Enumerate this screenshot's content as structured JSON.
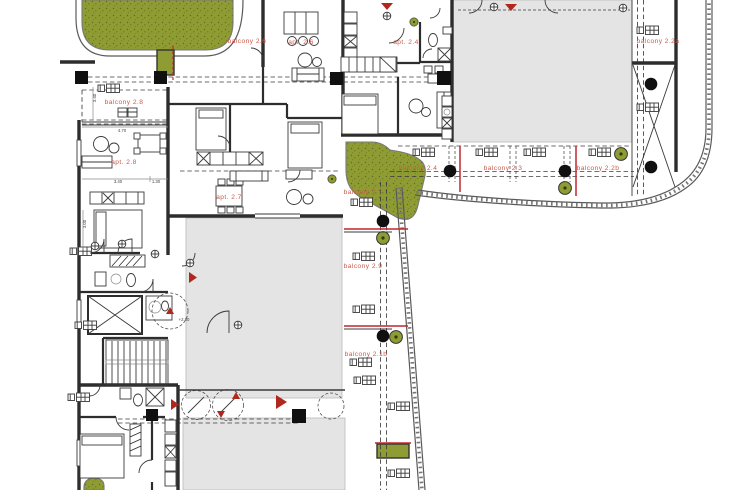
{
  "canvas": {
    "width": 734,
    "height": 490
  },
  "colors": {
    "background": "#ffffff",
    "grass": "#8f9c33",
    "grass_speckle": "#5f6d1c",
    "slab": "#e4e4e4",
    "wall": "#2d2d2d",
    "label_red": "#cd594b",
    "accent_red": "#c1272d",
    "column_black": "#101010"
  },
  "labels": {
    "balcony_2_8": "balcony 2.8",
    "apt_2_8": "apt. 2.8",
    "balcony_2_6": "balcony 2.6",
    "apt_2_6": "apt. 2.6",
    "apt_2_4": "apt. 2.4",
    "balcony_2_2a": "balcony 2.2a",
    "balcony_2_4": "balcony 2.4",
    "balcony_2_3": "balcony 2.3",
    "balcony_2_2b": "balcony 2.2b",
    "balcony_2_7": "balcony 2.7",
    "apt_2_7": "apt. 2.7",
    "balcony_2_9": "balcony 2.9",
    "balcony_2_1b": "balcony 2.1b"
  },
  "dimensions": {
    "living_width": "4.70",
    "kitchen_width": "3.40",
    "hall_width": "1.30",
    "room_depth": "3.40",
    "bedroom_depth": "3.00",
    "level_mark": "+2.80"
  },
  "symbols": {
    "tree": "tree-circle",
    "column": "structural-column-dot",
    "entrance": "entrance-arrow",
    "stairs": "staircase",
    "elevator": "elevator-shaft",
    "balcony_furniture": "table-and-chairs"
  }
}
